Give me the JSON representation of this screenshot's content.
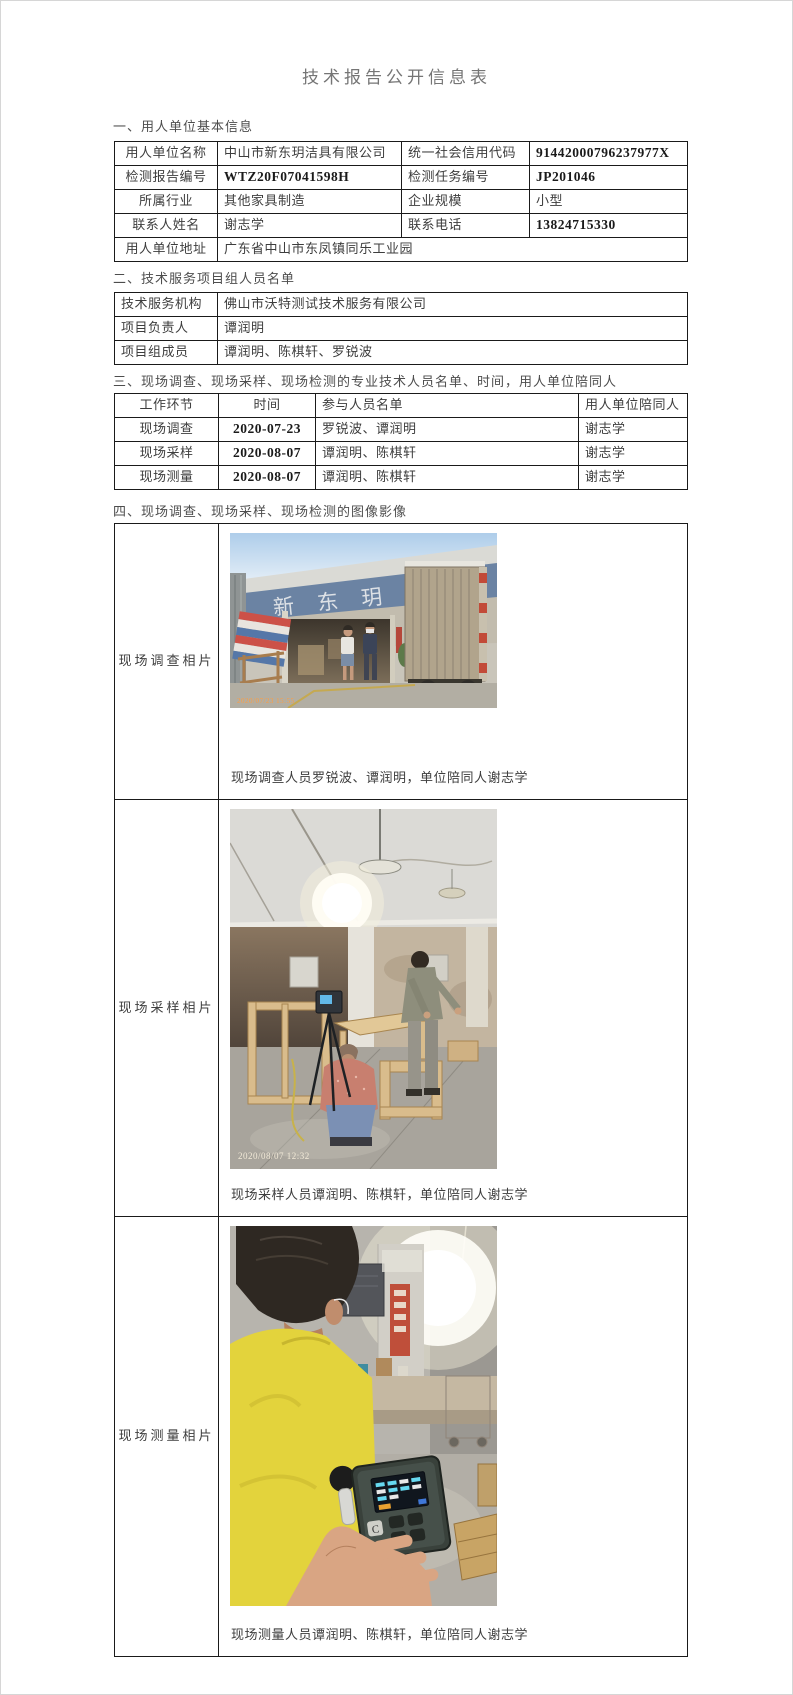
{
  "page": {
    "title": "技术报告公开信息表"
  },
  "s1": {
    "heading": "一、用人单位基本信息",
    "employer_name_label": "用人单位名称",
    "employer_name": "中山市新东玥洁具有限公司",
    "credit_code_label": "统一社会信用代码",
    "credit_code": "91442000796237977X",
    "report_no_label": "检测报告编号",
    "report_no": "WTZ20F07041598H",
    "task_no_label": "检测任务编号",
    "task_no": "JP201046",
    "industry_label": "所属行业",
    "industry": "其他家具制造",
    "scale_label": "企业规模",
    "scale": "小型",
    "contact_name_label": "联系人姓名",
    "contact_name": "谢志学",
    "phone_label": "联系电话",
    "phone": "13824715330",
    "address_label": "用人单位地址",
    "address": "广东省中山市东凤镇同乐工业园"
  },
  "s2": {
    "heading": "二、技术服务项目组人员名单",
    "agency_label": "技术服务机构",
    "agency": "佛山市沃特测试技术服务有限公司",
    "leader_label": "项目负责人",
    "leader": "谭润明",
    "members_label": "项目组成员",
    "members": "谭润明、陈棋轩、罗锐波"
  },
  "s3": {
    "heading": "三、现场调查、现场采样、现场检测的专业技术人员名单、时间，用人单位陪同人",
    "headers": [
      "工作环节",
      "时间",
      "参与人员名单",
      "用人单位陪同人"
    ],
    "rows": [
      {
        "step": "现场调查",
        "date": "2020-07-23",
        "staff": "罗锐波、谭润明",
        "escort": "谢志学"
      },
      {
        "step": "现场采样",
        "date": "2020-08-07",
        "staff": "谭润明、陈棋轩",
        "escort": "谢志学"
      },
      {
        "step": "现场测量",
        "date": "2020-08-07",
        "staff": "谭润明、陈棋轩",
        "escort": "谢志学"
      }
    ]
  },
  "s4": {
    "heading": "四、现场调查、现场采样、现场检测的图像影像",
    "rows": [
      {
        "label": "现场调查相片",
        "caption": "现场调查人员罗锐波、谭润明，单位陪同人谢志学",
        "photo_timestamp": "2020/07/23 15:55",
        "factory_sign_text": "新 东 玥 洁 具"
      },
      {
        "label": "现场采样相片",
        "caption": "现场采样人员谭润明、陈棋轩，单位陪同人谢志学",
        "photo_timestamp": "2020/08/07 12:32"
      },
      {
        "label": "现场测量相片",
        "caption": "现场测量人员谭润明、陈棋轩，单位陪同人谢志学"
      }
    ]
  },
  "colors": {
    "page_background": "#ffffff",
    "table_border": "#1a1a1a",
    "title_text": "#757575",
    "body_text": "#3d3d3d",
    "timestamp_orange": "#ff9d40",
    "factory_sign_band_blue": "#6b83a3",
    "tarp_red": "#cc5148",
    "tarp_blue": "#5577a8",
    "worker_shirt_yellow": "#e3d33c"
  }
}
